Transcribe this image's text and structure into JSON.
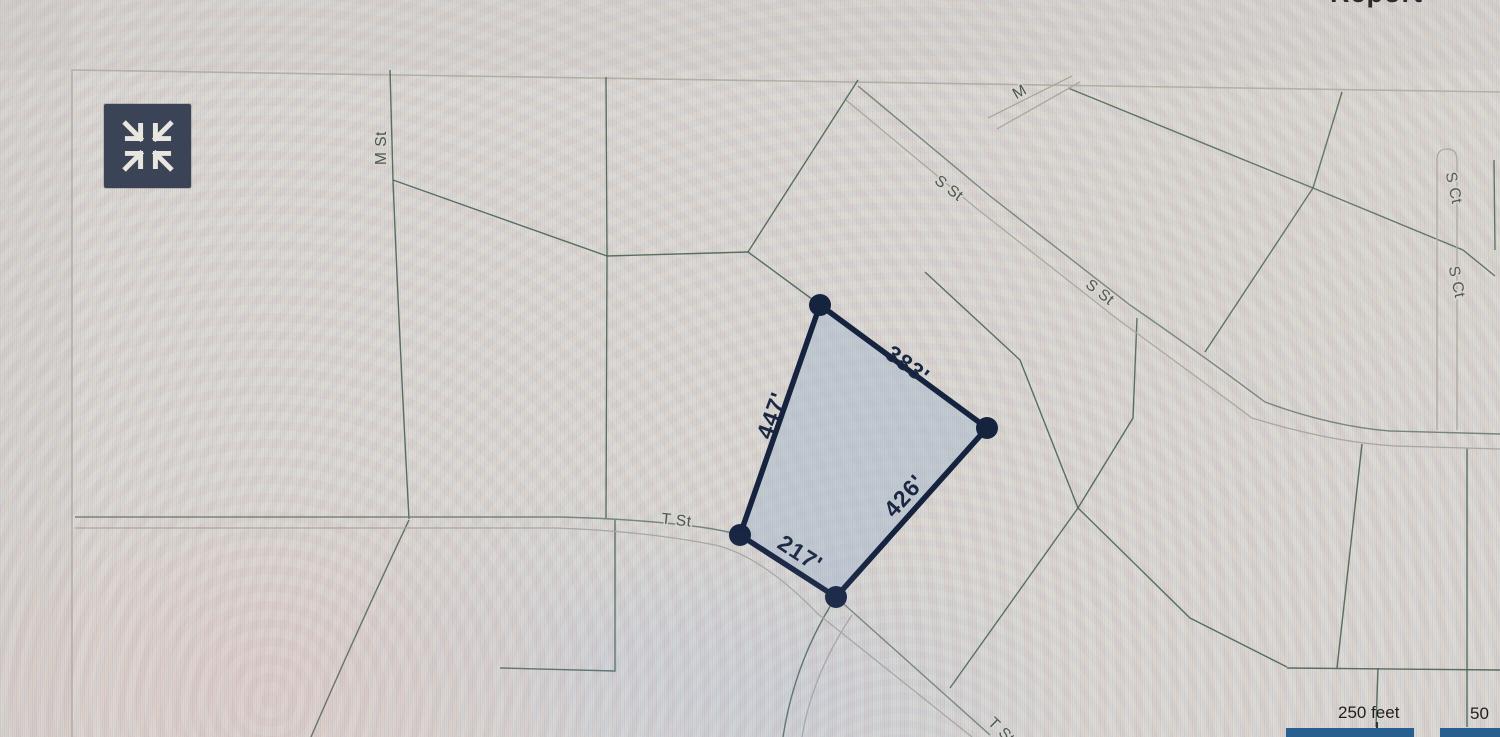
{
  "top_bar": {
    "partial_text": "Report"
  },
  "toolbar": {
    "collapse_button_icon": "collapse-arrows-icon"
  },
  "map": {
    "street_labels": [
      {
        "id": "m-st-left",
        "label": "M St"
      },
      {
        "id": "m-top",
        "label": "M"
      },
      {
        "id": "s-st-upper",
        "label": "S St"
      },
      {
        "id": "s-st-lower",
        "label": "S St"
      },
      {
        "id": "s-ct-upper",
        "label": "S Ct"
      },
      {
        "id": "s-ct-lower",
        "label": "S Ct"
      },
      {
        "id": "t-st",
        "label": "T St"
      },
      {
        "id": "t-st-bottom",
        "label": "T St"
      }
    ],
    "parcel": {
      "side_lengths": [
        {
          "edge": "north-east",
          "label": "383'"
        },
        {
          "edge": "west",
          "label": "447'"
        },
        {
          "edge": "south-east",
          "label": "426'"
        },
        {
          "edge": "south-west",
          "label": "217'"
        }
      ],
      "fill_color": "#bfc8d2",
      "outline_color": "#16233f"
    },
    "scale_bar": {
      "labels": [
        "250 feet",
        "50"
      ]
    },
    "colors": {
      "parcel_line": "#44614f",
      "road_line": "#aaa79f",
      "background": "#d8d5cf",
      "button": "#3b4457",
      "scale_bar": "#27608f"
    }
  }
}
